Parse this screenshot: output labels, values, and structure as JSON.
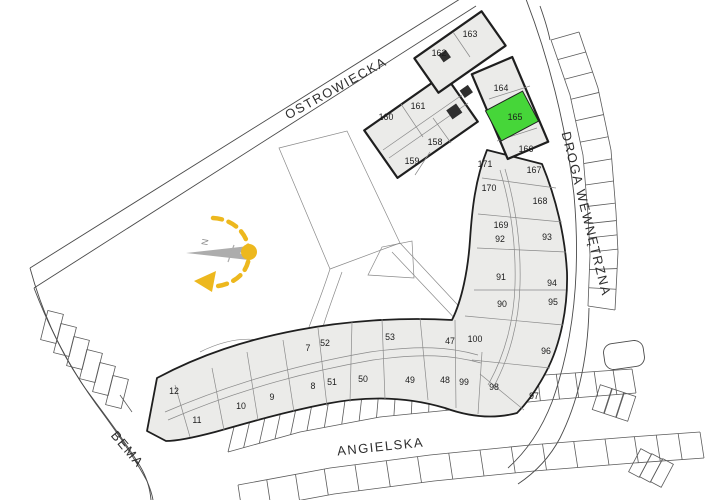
{
  "streets": [
    {
      "name": "OSTROWIECKA",
      "x": 338,
      "y": 92,
      "rot": -29
    },
    {
      "name": "DROGA WEWNĘTRZNA",
      "x": 582,
      "y": 215,
      "rot": 76
    },
    {
      "name": "ANGIELSKA",
      "x": 381,
      "y": 451,
      "rot": -6
    },
    {
      "name": "BEMA",
      "x": 124,
      "y": 452,
      "rot": 50
    }
  ],
  "highlighted_unit": {
    "label": "165"
  },
  "compass": {
    "north_label": "N"
  },
  "colors": {
    "building_fill": "#EBEBE9",
    "building_outline": "#1F1F1F",
    "interior_line": "#8A8A8A",
    "street_line": "#4A4A4A",
    "highlight_fill": "#46D639",
    "highlight_label": "#336622",
    "sun_yellow": "#EDB81E",
    "compass_gray": "#ADADAD",
    "label_color": "#1C1C1C"
  },
  "units": [
    {
      "label": "163",
      "x": 470,
      "y": 34
    },
    {
      "label": "162",
      "x": 439,
      "y": 53
    },
    {
      "label": "164",
      "x": 501,
      "y": 88
    },
    {
      "label": "161",
      "x": 418,
      "y": 106
    },
    {
      "label": "160",
      "x": 386,
      "y": 117
    },
    {
      "label": "165",
      "x": 515,
      "y": 117,
      "highlighted": true
    },
    {
      "label": "158",
      "x": 435,
      "y": 142
    },
    {
      "label": "166",
      "x": 526,
      "y": 149
    },
    {
      "label": "159",
      "x": 412,
      "y": 161
    },
    {
      "label": "171",
      "x": 485,
      "y": 164
    },
    {
      "label": "167",
      "x": 534,
      "y": 170
    },
    {
      "label": "170",
      "x": 489,
      "y": 188
    },
    {
      "label": "168",
      "x": 540,
      "y": 201
    },
    {
      "label": "169",
      "x": 501,
      "y": 225
    },
    {
      "label": "93",
      "x": 547,
      "y": 237
    },
    {
      "label": "92",
      "x": 500,
      "y": 239
    },
    {
      "label": "91",
      "x": 501,
      "y": 277
    },
    {
      "label": "94",
      "x": 552,
      "y": 283
    },
    {
      "label": "90",
      "x": 502,
      "y": 304
    },
    {
      "label": "95",
      "x": 553,
      "y": 302
    },
    {
      "label": "96",
      "x": 546,
      "y": 351
    },
    {
      "label": "97",
      "x": 534,
      "y": 396
    },
    {
      "label": "98",
      "x": 494,
      "y": 387
    },
    {
      "label": "99",
      "x": 464,
      "y": 382
    },
    {
      "label": "100",
      "x": 475,
      "y": 339
    },
    {
      "label": "47",
      "x": 450,
      "y": 341
    },
    {
      "label": "48",
      "x": 445,
      "y": 380
    },
    {
      "label": "49",
      "x": 410,
      "y": 380
    },
    {
      "label": "50",
      "x": 363,
      "y": 379
    },
    {
      "label": "53",
      "x": 390,
      "y": 337
    },
    {
      "label": "51",
      "x": 332,
      "y": 382
    },
    {
      "label": "52",
      "x": 325,
      "y": 343
    },
    {
      "label": "7",
      "x": 308,
      "y": 348
    },
    {
      "label": "8",
      "x": 313,
      "y": 386
    },
    {
      "label": "9",
      "x": 272,
      "y": 397
    },
    {
      "label": "10",
      "x": 241,
      "y": 406
    },
    {
      "label": "11",
      "x": 197,
      "y": 420
    },
    {
      "label": "12",
      "x": 174,
      "y": 391
    }
  ]
}
